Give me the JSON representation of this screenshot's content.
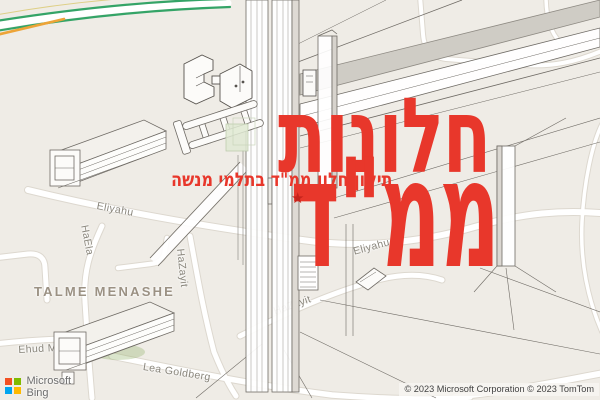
{
  "overlay": {
    "title": "חלונות",
    "subtitle": "תיקון חלון ממ\"ד בתלמי מנשה",
    "title_main": "ממ\"ד",
    "star": "★",
    "accent_color": "#e8372b"
  },
  "map": {
    "city": "TALME MENASHE",
    "streets": {
      "eliyahu_left": "Eliyahu",
      "haela": "HaEla",
      "hazayit_vertical": "HaZayit",
      "hazayit_diagonal": "HaZayit",
      "eliyahu_right": "Eliyahu",
      "ehud_manor": "Ehud Manor",
      "lea_goldberg": "Lea Goldberg"
    },
    "traffic_colors": {
      "free_flow": "#34a467",
      "slow": "#eda437"
    }
  },
  "branding": {
    "microsoft": "Microsoft",
    "bing": "Bing",
    "logo_colors": {
      "red": "#f25022",
      "green": "#7fba00",
      "blue": "#00a4ef",
      "yellow": "#ffb900"
    }
  },
  "attribution": "© 2023 Microsoft Corporation © 2023 TomTom"
}
